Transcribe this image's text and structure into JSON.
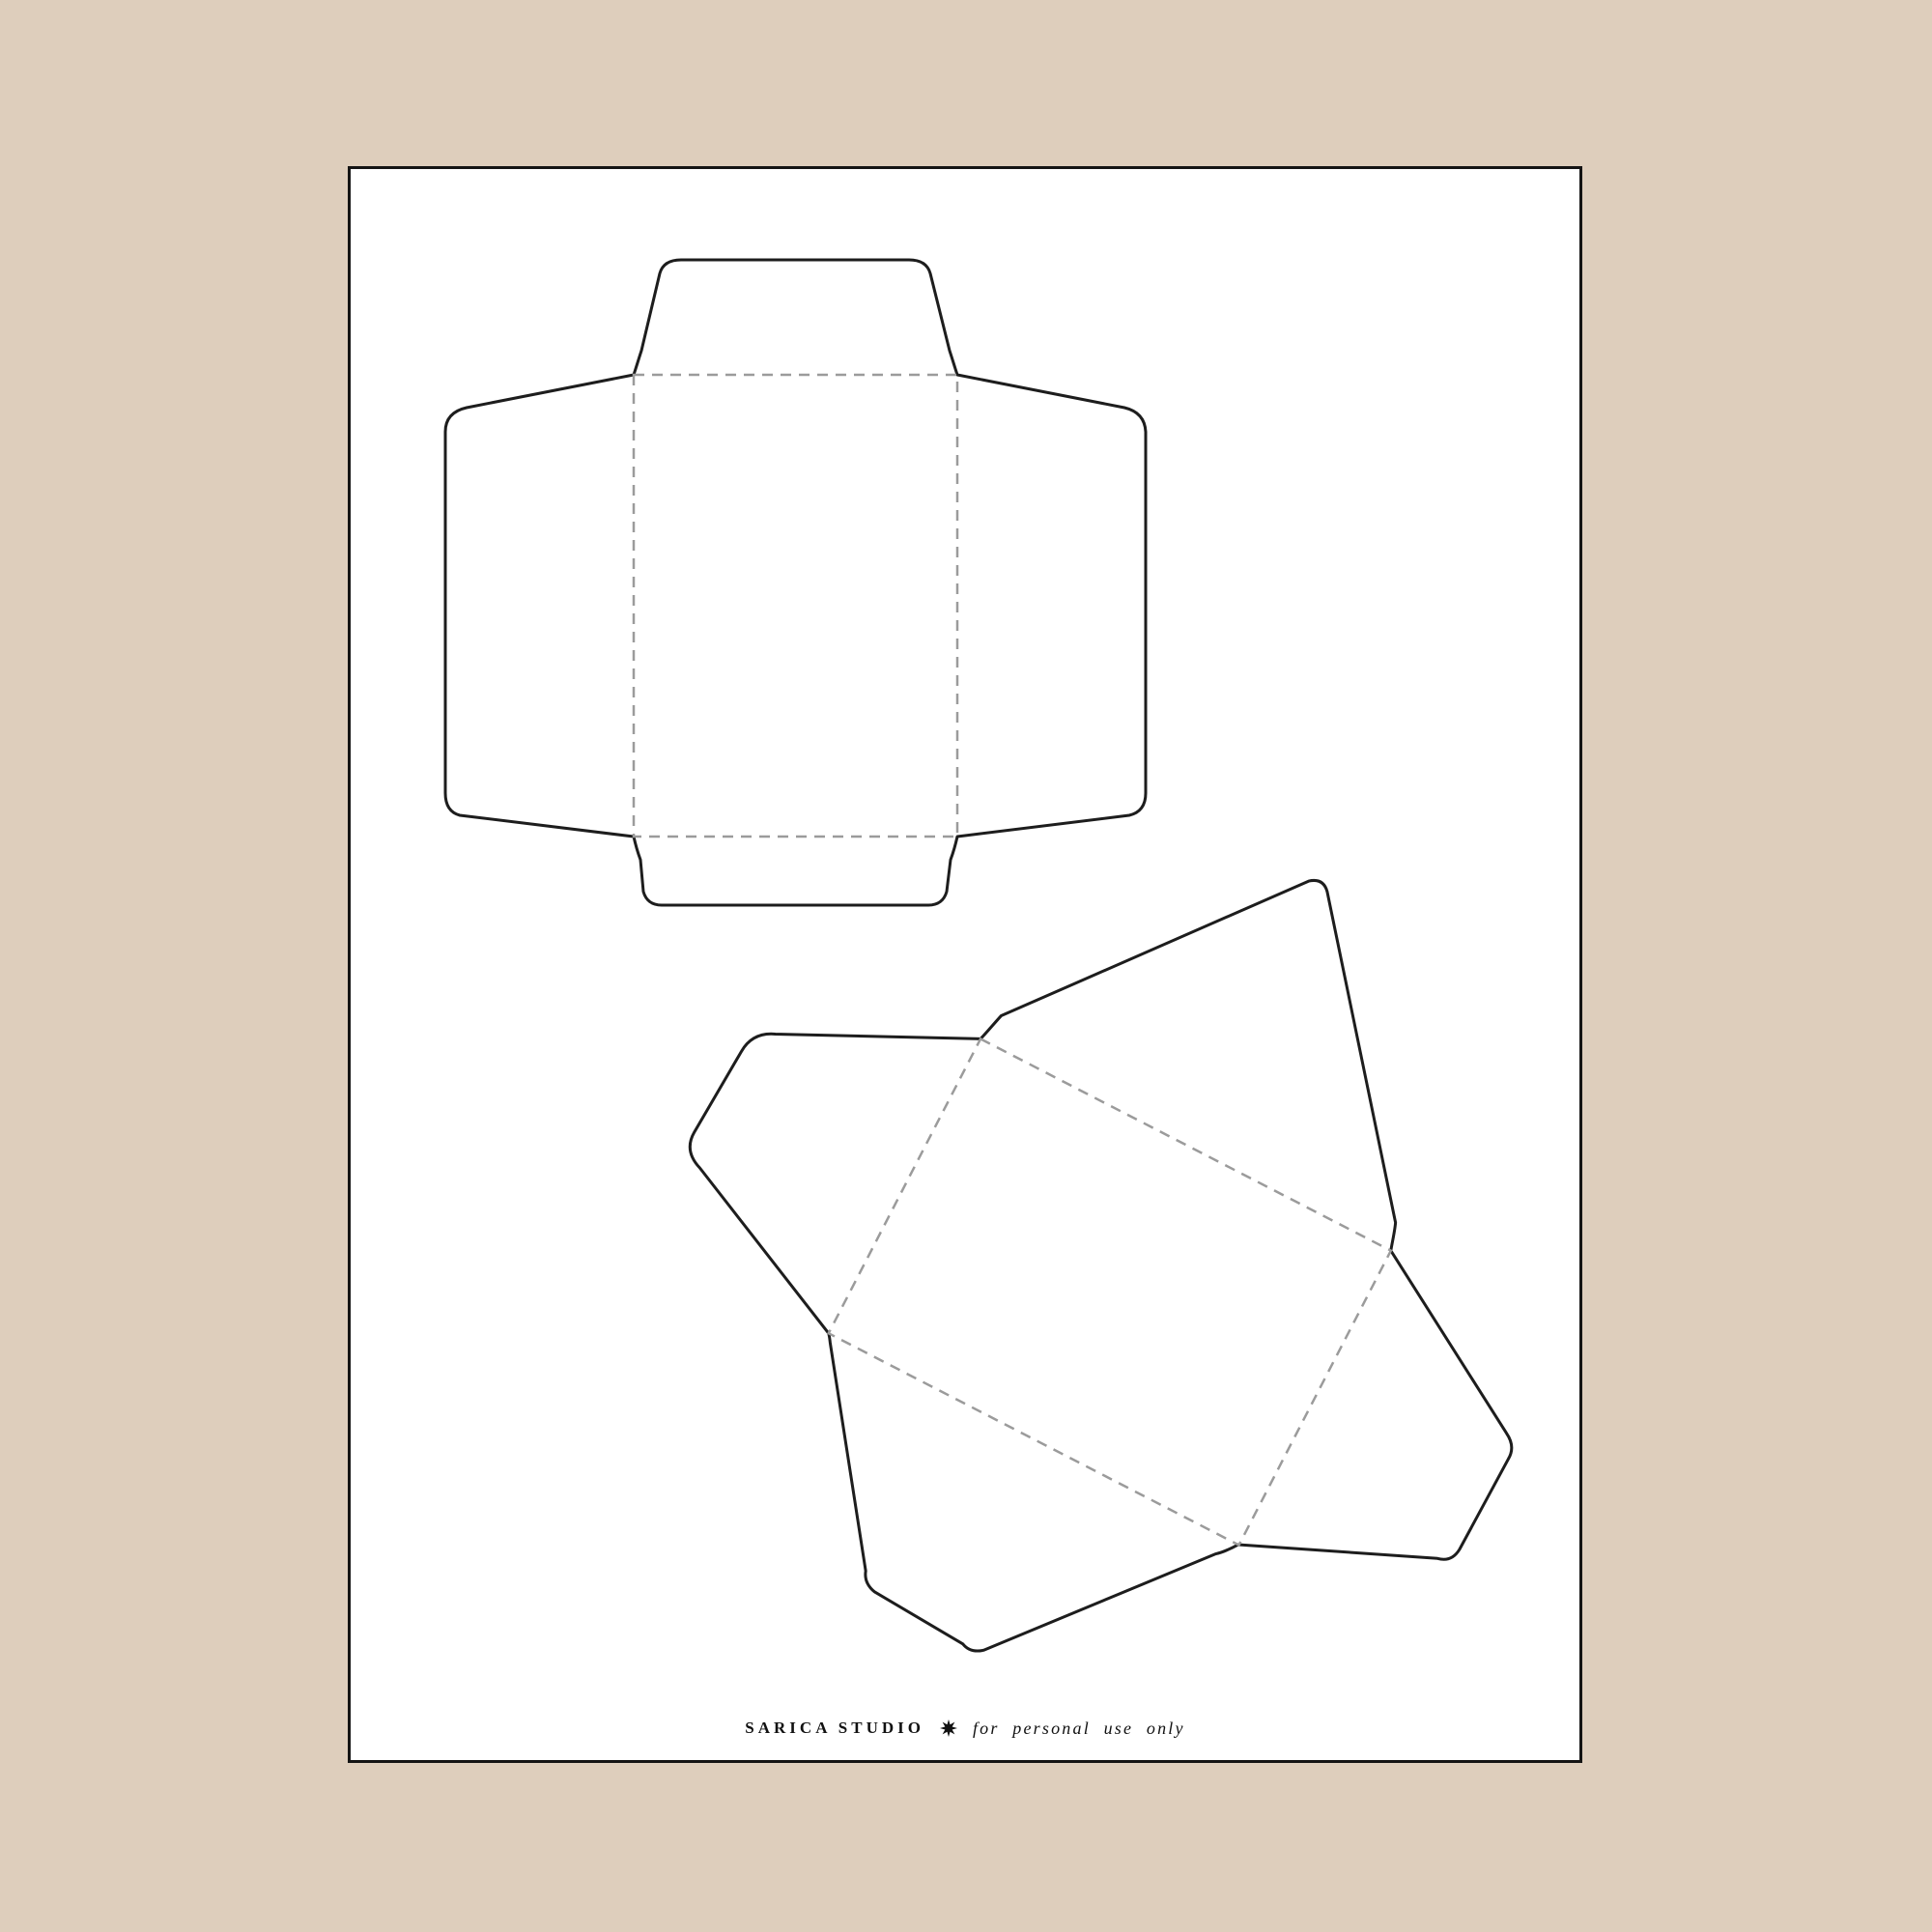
{
  "theme": {
    "desk_background": "#decebc",
    "sheet_background": "#ffffff",
    "sheet_border": "#141414",
    "cut_line_color": "#1d1d1d",
    "fold_line_color": "#9b9b9b",
    "text_color": "#111111"
  },
  "sheet": {
    "kind": "printable envelope template sheet",
    "templates": [
      {
        "name": "envelope-template-upright",
        "line_styles": {
          "solid": "cut line",
          "dashed": "fold line"
        }
      },
      {
        "name": "envelope-template-rotated",
        "line_styles": {
          "solid": "cut line",
          "dashed": "fold line"
        }
      }
    ]
  },
  "footer": {
    "brand": "SARICA STUDIO",
    "separator_icon": "eight-point-star",
    "note": "for personal use only"
  }
}
